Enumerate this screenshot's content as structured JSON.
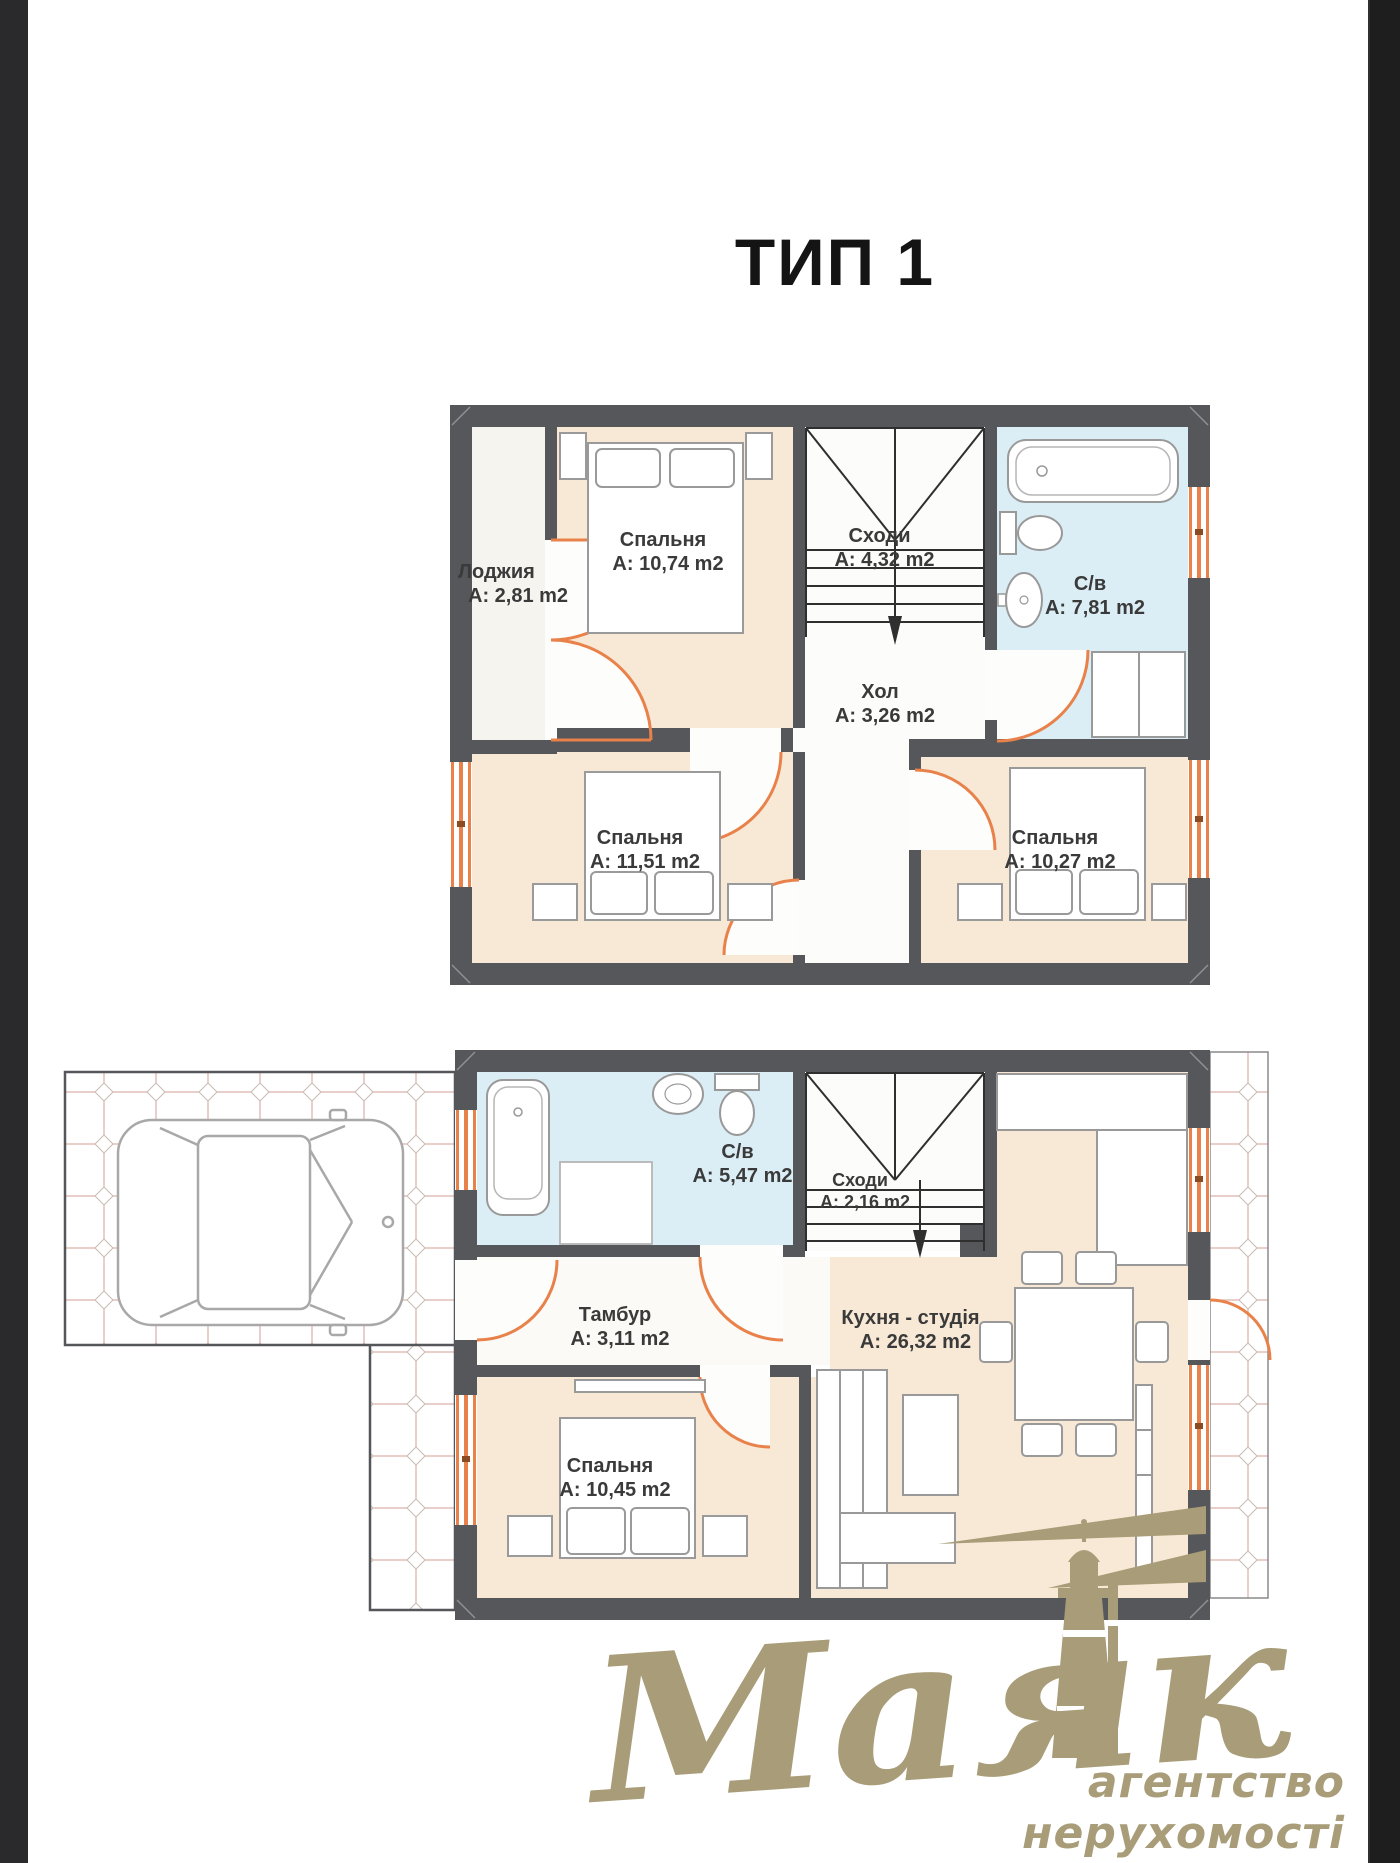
{
  "title": "ТИП 1",
  "floors": {
    "upper": {
      "rooms": [
        {
          "id": "loggia",
          "name": "Лоджия",
          "area": "А: 2,81 m2"
        },
        {
          "id": "bedroom1",
          "name": "Спальня",
          "area": "А: 10,74 m2"
        },
        {
          "id": "stairs",
          "name": "Сходи",
          "area": "А: 4,32 m2"
        },
        {
          "id": "bathroom",
          "name": "С/в",
          "area": "А: 7,81 m2"
        },
        {
          "id": "hall",
          "name": "Хол",
          "area": "А: 3,26 m2"
        },
        {
          "id": "bedroom2",
          "name": "Спальня",
          "area": "А: 11,51 m2"
        },
        {
          "id": "bedroom3",
          "name": "Спальня",
          "area": "А: 10,27 m2"
        }
      ]
    },
    "lower": {
      "rooms": [
        {
          "id": "bathroom",
          "name": "С/в",
          "area": "А: 5,47 m2"
        },
        {
          "id": "stairs",
          "name": "Сходи",
          "area": "А: 2,16 m2"
        },
        {
          "id": "vestibule",
          "name": "Тамбур",
          "area": "А: 3,11 m2"
        },
        {
          "id": "kitchen",
          "name": "Кухня - студія",
          "area": "А: 26,32 m2"
        },
        {
          "id": "bedroom",
          "name": "Спальня",
          "area": "А: 10,45 m2"
        }
      ]
    }
  },
  "logo": {
    "brand": "Маяк",
    "tagline": "агентство нерухомості",
    "color": "#a89d78"
  },
  "colors": {
    "wall": "#56575a",
    "room_warm": "#f8e9d7",
    "room_wet": "#dceef5",
    "accent_orange": "#e8824a",
    "paving_pink": "#e0b3ac",
    "logo_gold": "#a89d78"
  }
}
